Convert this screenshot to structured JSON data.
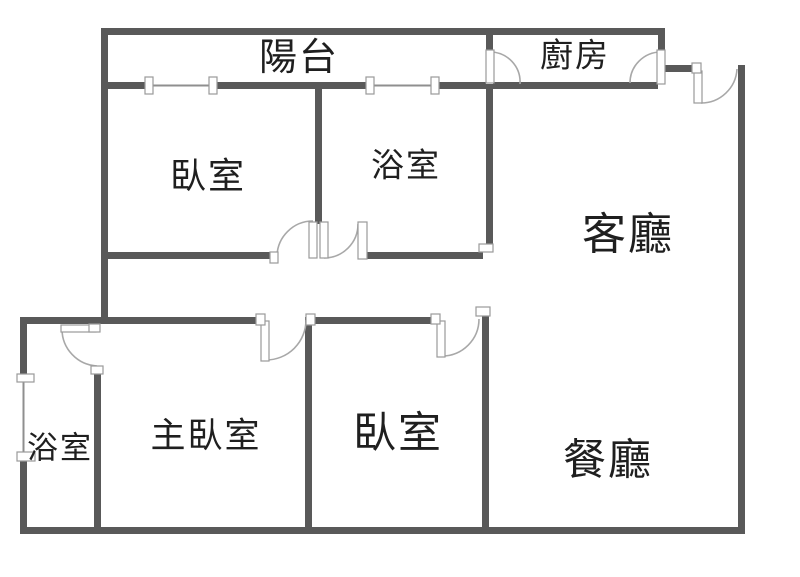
{
  "rooms": {
    "balcony": "陽台",
    "kitchen": "廚房",
    "bedroom_upper": "臥室",
    "bathroom_upper": "浴室",
    "living_room": "客廳",
    "bathroom_lower": "浴室",
    "master_bedroom": "主臥室",
    "bedroom_lower": "臥室",
    "dining_room": "餐廳"
  },
  "colors": {
    "wall": "#595959",
    "thin": "#8f8f8f",
    "arc": "#a8a8a8",
    "text": "#1f1f1f",
    "bg": "#ffffff"
  }
}
